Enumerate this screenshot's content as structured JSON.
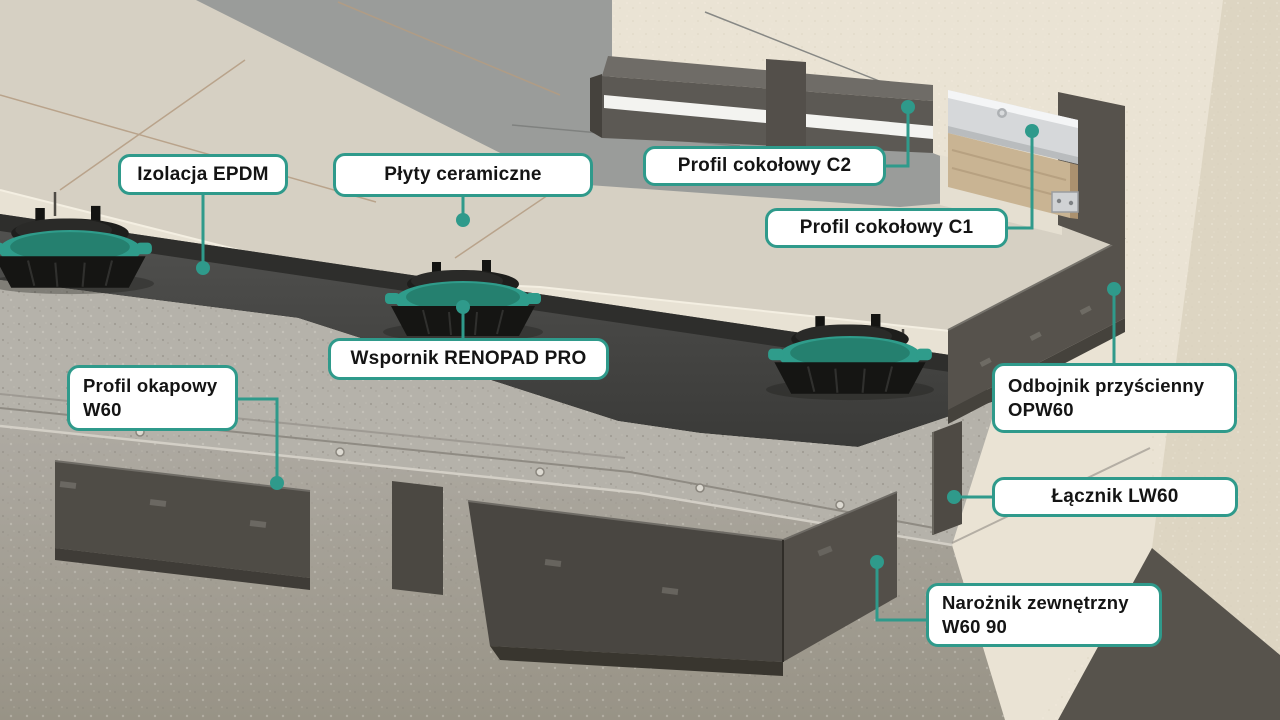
{
  "diagram": {
    "description": "Exploded 3D detail of a ventilated terrace system on a balcony corner",
    "colors": {
      "accent": "#2f9a8b",
      "label_bg": "#ffffff",
      "label_border": "#2f9a8b",
      "label_text": "#141414",
      "tile": "#d6d0c3",
      "tile_shadow": "#999b9a",
      "wall": "#eae3d4",
      "membrane": "#434341",
      "concrete": "#b3b0a8",
      "dark_profile": "#4f4c46",
      "pedestal_ring": "#2f9c8b",
      "aluminum": "#d6d8da",
      "wood": "#c9b493"
    },
    "labels": [
      {
        "id": "izolacja-epdm",
        "text": "Izolacja EPDM"
      },
      {
        "id": "plyty-ceramiczne",
        "text": "Płyty ceramiczne"
      },
      {
        "id": "profil-cokolowy-c2",
        "text": "Profil cokołowy C2"
      },
      {
        "id": "profil-cokolowy-c1",
        "text": "Profil cokołowy C1"
      },
      {
        "id": "wspornik-renopad-pro",
        "text": "Wspornik RENOPAD PRO"
      },
      {
        "id": "profil-okapowy-w60",
        "text": "Profil okapowy\nW60"
      },
      {
        "id": "odbojnik-przyscienny-opw60",
        "text": "Odbojnik przyścienny\nOPW60"
      },
      {
        "id": "lacznik-lw60",
        "text": "Łącznik LW60"
      },
      {
        "id": "naroznik-zewnetrzny-w60-90",
        "text": "Narożnik zewnętrzny\nW60 90"
      }
    ]
  }
}
